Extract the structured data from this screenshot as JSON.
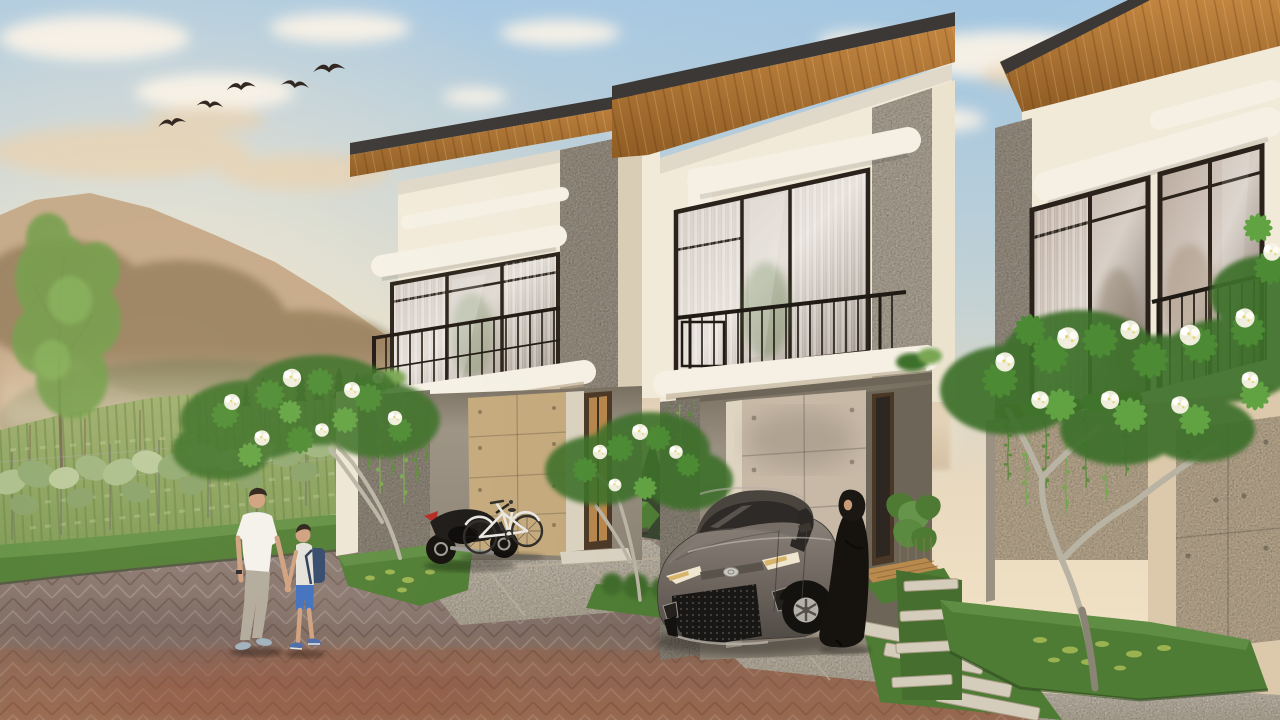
{
  "scene": {
    "type": "architectural-exterior-render",
    "setting": "Row of three modern two-storey tropical minimalist townhouses at golden hour, hazy mountains and a leafy crop field to the left, herringbone paver street in the foreground",
    "time_of_day": "sunset golden hour",
    "houses": [
      {
        "label": "house-1",
        "features": [
          "mono-pitch roof, charcoal fascia, wood soffit",
          "full-height glass with sheer curtains",
          "balcony with black metal railing",
          "tan concrete-panel garage door",
          "hanging vines on side wall"
        ]
      },
      {
        "label": "house-2",
        "features": [
          "mono-pitch roof, charcoal fascia, wood soffit",
          "full-height glass with sheer curtains",
          "balcony with black metal railing",
          "concrete-panel garage door with form-tie dots",
          "entry porch with wooden deck step and taro plants"
        ]
      },
      {
        "label": "house-3",
        "features": [
          "mono-pitch roof, charcoal fascia, wood soffit",
          "corner glass windows",
          "balcony with black metal railing",
          "low planter wall with trailing vines",
          "concrete-panel gate"
        ]
      }
    ],
    "figures": [
      {
        "label": "man",
        "desc": "dark-haired man in white t-shirt, beige trousers, grey-blue sneakers, wristwatch, walking hand in hand with boy"
      },
      {
        "label": "boy",
        "desc": "boy in light grey long-sleeve top, blue shorts, navy backpack, blue sneakers"
      },
      {
        "label": "woman",
        "desc": "woman in black abaya and hijab standing beside parked sedan"
      }
    ],
    "vehicles": [
      {
        "label": "sedan",
        "desc": "bronze-grey sedan parked nose-out on middle driveway"
      },
      {
        "label": "motorcycle",
        "desc": "black motorcycle with red tail accent parked by first garage"
      },
      {
        "label": "bicycle",
        "desc": "white city bicycle parked beside motorcycle"
      }
    ],
    "nature": {
      "birds_in_flight": 5,
      "frangipani_trees_with_white_blooms": 3,
      "mountains": "hazy warm sunlit ridges with forested slopes",
      "field": "sage-green crop rows behind a big-leaf trellis hedge",
      "conifers": "dark evergreens between field and houses"
    },
    "ground": {
      "street": "grey-mauve herringbone pavers with warm red-brown band near bottom",
      "driveways": "light speckled concrete with joint lines",
      "details": [
        "stepping stones with grass joints",
        "raised grass beds with leaf litter"
      ]
    }
  },
  "colors": {
    "sky_top": "#a9c9e2",
    "sky_mid": "#ccd5d1",
    "sky_low": "#e9d9bf",
    "sky_horizon": "#f2e3c6",
    "sky_glow": "#f8e8cc",
    "cloud_white": "#fbf4e8",
    "cloud_warm": "#eecfa6",
    "bird": "#2e241e",
    "mtn_far": "#d5bfa3",
    "mtn_near": "#c4a888",
    "mtn_forest": "#77643f",
    "mtn_forest_green": "#5f6b3f",
    "mist": "#f2e4c8",
    "field_top": "#9fae6e",
    "field_bot": "#7b9852",
    "crop_row": "#628044",
    "pole": "#7d6750",
    "tuft": "#c8d0a0",
    "hedge_a": "#a9bd8a",
    "hedge_b": "#8fa871",
    "hedge_c": "#b9c898",
    "hedge_d": "#9cb37e",
    "hedge_e": "#87a068",
    "trellis": "#6f6f66",
    "wire": "#a8a89a",
    "berm_grass": "#4f7c35",
    "berm_light": "#65934a",
    "curb": "#514c44",
    "conifer_a": "#46543a",
    "conifer_b": "#39462f",
    "thin_trunk": "#7a6a52",
    "thin_leaf": "#6f9c4a",
    "thin_leaf_light": "#86b25c",
    "roof_dark": "#3b3836",
    "wood_light": "#c28540",
    "wood_dark": "#8f5c24",
    "wall_cream": "#f2ead9",
    "wall_white": "#f5f0e3",
    "wall_shadow": "#d9cdb6",
    "pier_grey": "#b3a899",
    "pier_warm": "#c9bfae",
    "pier_dark": "#a39a8b",
    "frame_dark": "#2b231b",
    "railing": "#201a14",
    "recess": "#8b8274",
    "recess_dark": "#6e6559",
    "panel_tan": "#c3a87b",
    "panel_concrete": "#c7b9a6",
    "panel_door3": "#d8c5a7",
    "door_wood": "#4a3826",
    "door_glass_warm": "#b5854c",
    "deck_wood": "#b98a4e",
    "drive_concrete": "#dbd2c2",
    "drive_joint": "#b9ad9a",
    "stone": "#d5cdbb",
    "road_top": "#8f7f78",
    "road_mid": "#7d6a62",
    "road_low": "#936f58",
    "road_warm": "#a05a3b",
    "road_red": "#8a4a36",
    "grass_patch": "#4e7c34",
    "grass_dark": "#3f6b2c",
    "litter": "#a8bc56",
    "frangi_blob": "#3e702c",
    "frangi_leaf": "#4c8a34",
    "frangi_leaf_light": "#61a243",
    "bloom_white": "#f6f3e4",
    "bloom_yellow": "#e8d36a",
    "frangi_trunk": "#b9b3a4",
    "vine_green": "#5d8a3c",
    "vine_light": "#79a653",
    "taro": "#4e7a33",
    "moto_black": "#1c1a19",
    "moto_red": "#b32a24",
    "chrome": "#9a9a96",
    "bike_white": "#e8e6e0",
    "bike_dark": "#2e2b28",
    "car_top": "#8d847c",
    "car_body": "#6e655e",
    "car_dark": "#4f4a44",
    "car_glass": "#2e2a27",
    "car_trim": "#cfc8c0",
    "tire": "#14120f",
    "rim": "#b4b1ab",
    "headlight": "#efe6cf",
    "skin": "#cf9f7e",
    "hair_dark": "#2c241d",
    "tee_white": "#f4f1ea",
    "pants_grey": "#b0a89a",
    "shoe_blue": "#9fb0bd",
    "collar_teal": "#7e98a8",
    "boy_top": "#e4e1da",
    "boy_shorts": "#3f6fbe",
    "backpack": "#33486b",
    "boy_shoe": "#4a6aa8",
    "abaya": "#16120e",
    "hijab": "#1b1713"
  }
}
